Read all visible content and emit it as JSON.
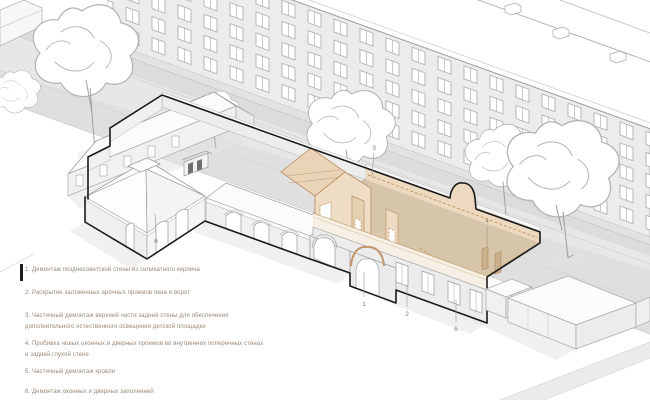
{
  "legend": {
    "items": [
      {
        "text": "1. Демонтаж позднесоветской стены из силикатного кирпича"
      },
      {
        "text": "2. Раскрытие заложенных арочных проемов окна и ворот"
      },
      {
        "text": "3. Частичный демонтаж верхней части задней стены для обеспечения\nдополнительного естественного освещения детской площадки"
      },
      {
        "text": "4. Пробивка новых оконных и дверных проемов во внутренних поперечных стенах\nи задней глухой стене"
      },
      {
        "text": "5. Частичный демонтаж кровли"
      },
      {
        "text": "6. Демонтаж оконных и дверных заполнений"
      }
    ]
  },
  "annotations": {
    "marker_1": "1",
    "marker_2": "2",
    "marker_3": "3",
    "marker_4": "4",
    "marker_6_left": "6",
    "marker_6_right": "6"
  },
  "colors": {
    "background": "#ffffff",
    "street": "#e3e3e3",
    "building_gray": "#ececec",
    "demolition_band": "#ecd9bf",
    "demolition_floor": "#d7c5a9",
    "demolition_edge": "#b98c62",
    "heritage_outline": "#1a1a1a",
    "legend_text": "#99887a"
  }
}
